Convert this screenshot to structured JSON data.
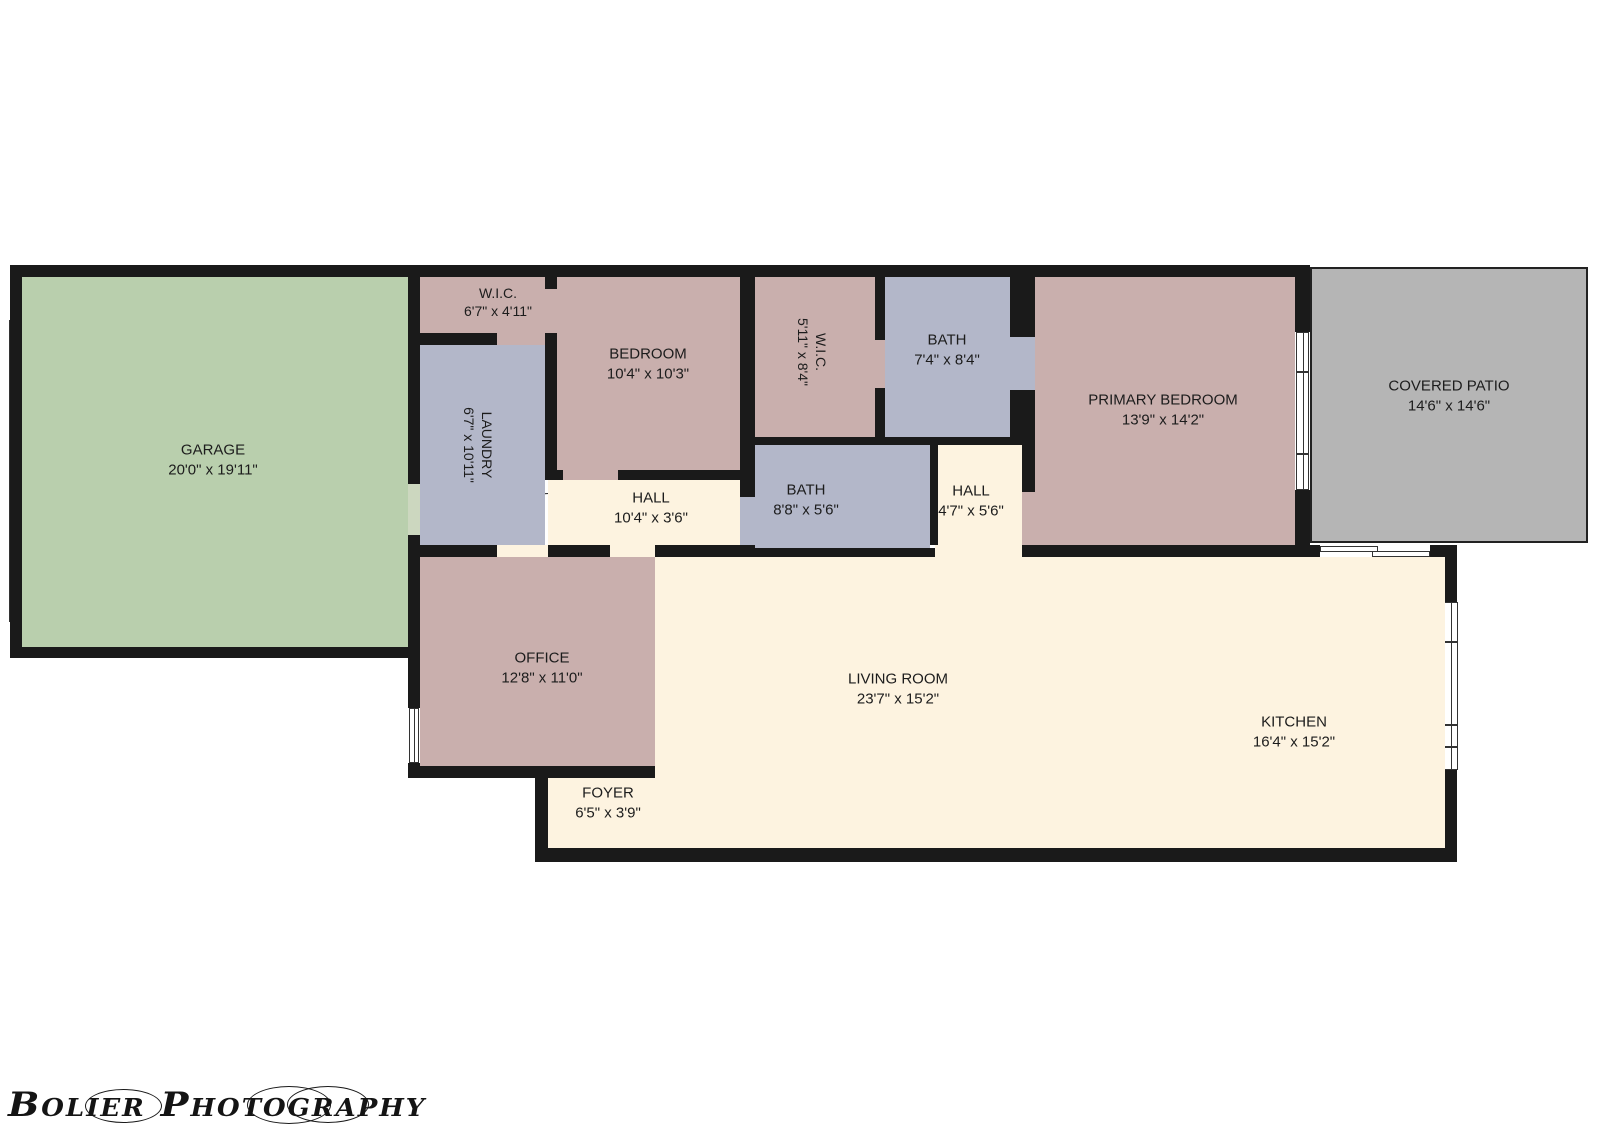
{
  "palette": {
    "paper": "#ffffff",
    "wall": "#1a1a1a",
    "line": "#333333",
    "text": "#1c1c1c",
    "pink": "#c9afad",
    "lavender": "#b3b7c9",
    "green": "#b9cfad",
    "cream": "#fdf3e0",
    "gray": "#b5b5b5",
    "door_leaf": "#ccd7bf"
  },
  "rooms": [
    {
      "id": "garage",
      "label": "GARAGE",
      "dims": "20'0\" x 19'11\"",
      "color": "green"
    },
    {
      "id": "wic1",
      "label": "W.I.C.",
      "dims": "6'7\" x 4'11\"",
      "color": "pink"
    },
    {
      "id": "bedroom",
      "label": "BEDROOM",
      "dims": "10'4\" x 10'3\"",
      "color": "pink"
    },
    {
      "id": "laundry",
      "label": "LAUNDRY",
      "dims": "6'7\" x 10'11\"",
      "color": "lavender"
    },
    {
      "id": "wic2",
      "label": "W.I.C.",
      "dims": "5'11\" x 8'4\"",
      "color": "pink"
    },
    {
      "id": "bath1",
      "label": "BATH",
      "dims": "7'4\" x 8'4\"",
      "color": "lavender"
    },
    {
      "id": "bath2",
      "label": "BATH",
      "dims": "8'8\" x 5'6\"",
      "color": "lavender"
    },
    {
      "id": "hall1",
      "label": "HALL",
      "dims": "10'4\" x 3'6\"",
      "color": "cream"
    },
    {
      "id": "hall2",
      "label": "HALL",
      "dims": "4'7\" x 5'6\"",
      "color": "cream"
    },
    {
      "id": "primary",
      "label": "PRIMARY BEDROOM",
      "dims": "13'9\" x 14'2\"",
      "color": "pink"
    },
    {
      "id": "patio",
      "label": "COVERED PATIO",
      "dims": "14'6\" x 14'6\"",
      "color": "gray"
    },
    {
      "id": "office",
      "label": "OFFICE",
      "dims": "12'8\" x 11'0\"",
      "color": "pink"
    },
    {
      "id": "foyer",
      "label": "FOYER",
      "dims": "6'5\" x 3'9\"",
      "color": "cream"
    },
    {
      "id": "living",
      "label": "LIVING ROOM",
      "dims": "23'7\" x 15'2\"",
      "color": "cream"
    },
    {
      "id": "kitchen",
      "label": "KITCHEN",
      "dims": "16'4\" x 15'2\"",
      "color": "cream"
    }
  ],
  "watermark": {
    "text": "Bolier Photography"
  }
}
